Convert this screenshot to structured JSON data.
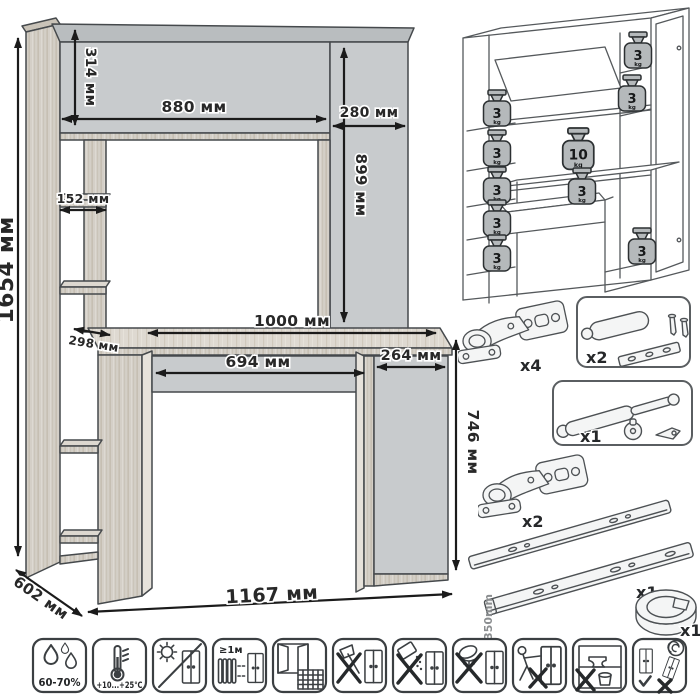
{
  "dimensions": {
    "total_height": "1654 мм",
    "hutch_height": "314 мм",
    "hutch_width": "880 мм",
    "top_cabinet_width": "280 мм",
    "top_cabinet_height": "899 мм",
    "shelf_width": "152 мм",
    "shelf_depth": "298 мм",
    "desktop_width": "1000 мм",
    "drawer_width": "694 мм",
    "pedestal_width": "264 мм",
    "desk_height": "746 мм",
    "depth": "602 мм",
    "total_width": "1167 мм"
  },
  "load_limits": {
    "weights": [
      {
        "value": "3",
        "unit": "kg",
        "location": "left-shelf-1"
      },
      {
        "value": "3",
        "unit": "kg",
        "location": "left-shelf-2"
      },
      {
        "value": "3",
        "unit": "kg",
        "location": "left-shelf-3"
      },
      {
        "value": "3",
        "unit": "kg",
        "location": "left-shelf-4"
      },
      {
        "value": "3",
        "unit": "kg",
        "location": "left-shelf-5"
      },
      {
        "value": "3",
        "unit": "kg",
        "location": "top-right-shelf"
      },
      {
        "value": "3",
        "unit": "kg",
        "location": "right-shelf"
      },
      {
        "value": "10",
        "unit": "kg",
        "location": "desktop"
      },
      {
        "value": "3",
        "unit": "kg",
        "location": "drawer"
      },
      {
        "value": "3",
        "unit": "kg",
        "location": "pedestal-shelf"
      }
    ]
  },
  "hardware": {
    "items": [
      {
        "id": "concealed-hinge",
        "count": "x4"
      },
      {
        "id": "door-damper",
        "count": "x2"
      },
      {
        "id": "gas-lift",
        "count": "x1"
      },
      {
        "id": "concealed-hinge",
        "count": "x2"
      },
      {
        "id": "drawer-slides",
        "count": "x1",
        "length": "350mm"
      },
      {
        "id": "cable-grommet",
        "count": "x1"
      }
    ]
  },
  "care": {
    "items": [
      {
        "id": "humidity",
        "label": "60-70%"
      },
      {
        "id": "temperature",
        "label": "+10...+25°C"
      },
      {
        "id": "no-direct-sunlight",
        "label": ""
      },
      {
        "id": "radiator-distance",
        "label": "≥1м"
      },
      {
        "id": "ventilate-room",
        "label": ""
      },
      {
        "id": "no-impacts",
        "label": ""
      },
      {
        "id": "no-abrasives",
        "label": ""
      },
      {
        "id": "no-solvents",
        "label": ""
      },
      {
        "id": "no-dragging",
        "label": ""
      },
      {
        "id": "no-overloading",
        "label": ""
      },
      {
        "id": "transport-upright",
        "label": ""
      }
    ]
  },
  "colors": {
    "panel": "#c8cbcd",
    "panel_top": "#b9bdbf",
    "wood": "#d4cfc7",
    "outline": "#45494c",
    "dimension_text": "#282828",
    "weight_fill": "#b5b9bb"
  }
}
